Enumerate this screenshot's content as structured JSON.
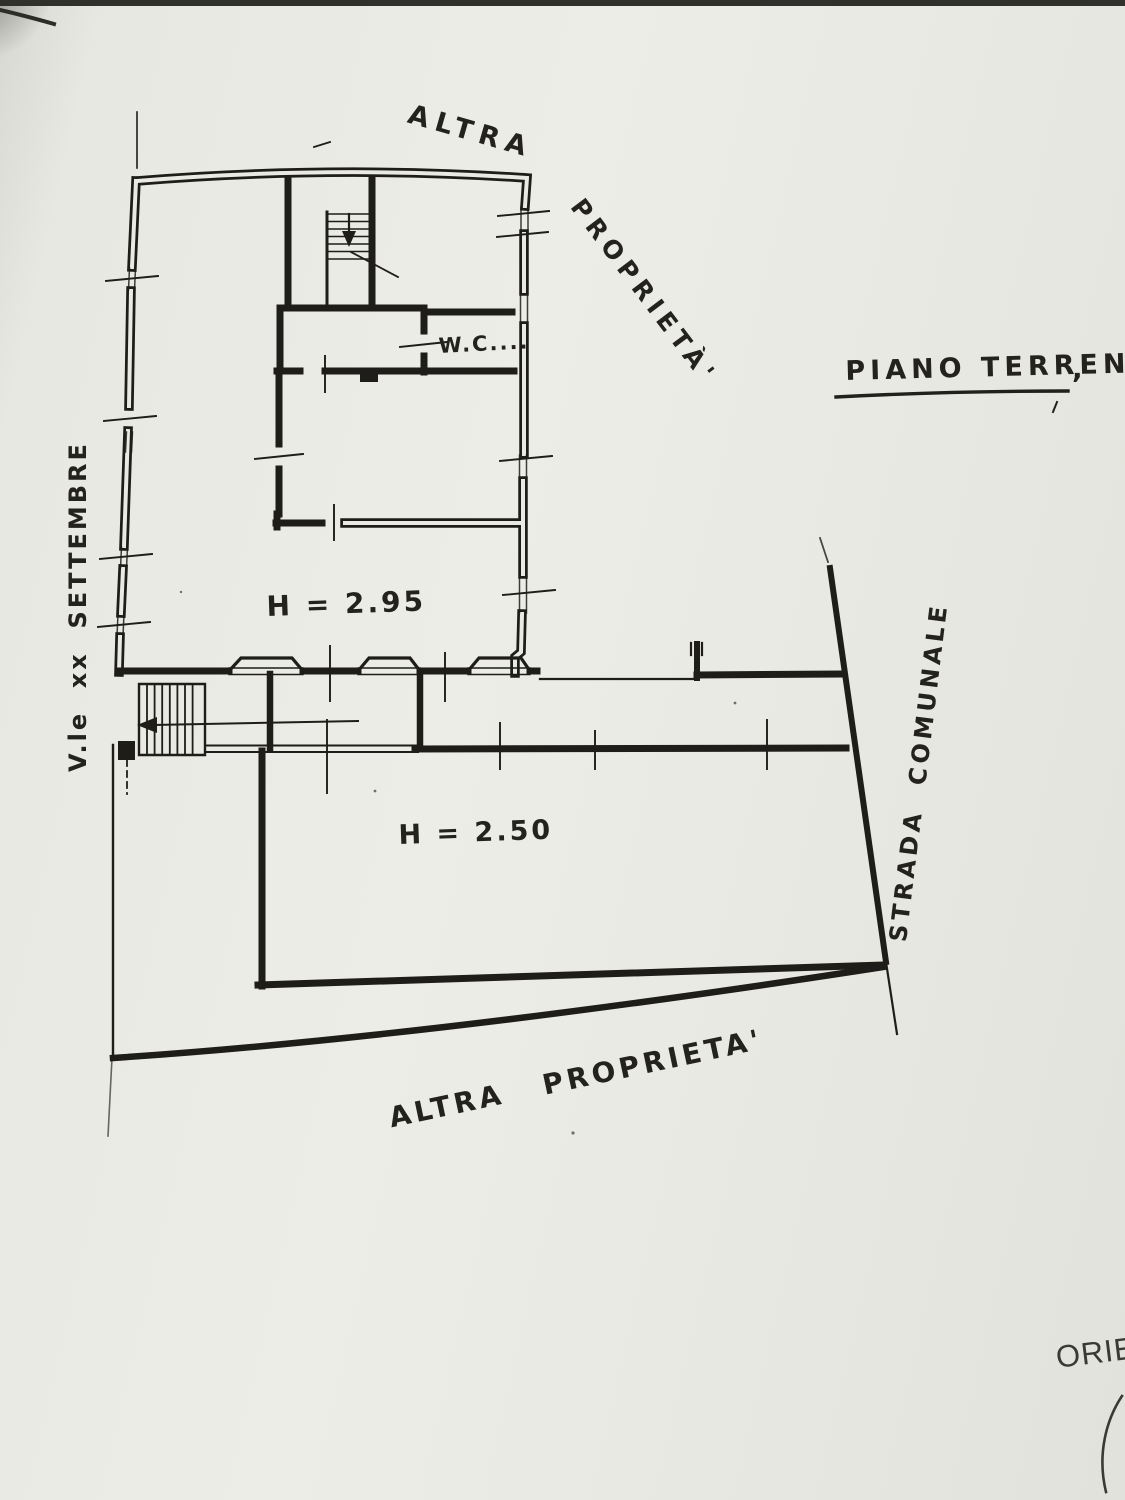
{
  "page": {
    "plan_title": "PIANO TERRENO",
    "plan_title_comma": ",",
    "orientation_label_partial": "ORIEN"
  },
  "boundaries": {
    "top_adjacent_word1": "ALTRA",
    "top_adjacent_word2": "PROPRIETÀ'",
    "bottom_adjacent": "ALTRA PROPRIETA'",
    "street_left_vertical": "V.le  xx  SETTEMBRE",
    "street_right_diagonal": "STRADA  COMUNALE"
  },
  "rooms": {
    "wc_label": "W.C....",
    "height_ground_main": "H = 2.95",
    "height_annex": "H = 2.50"
  }
}
